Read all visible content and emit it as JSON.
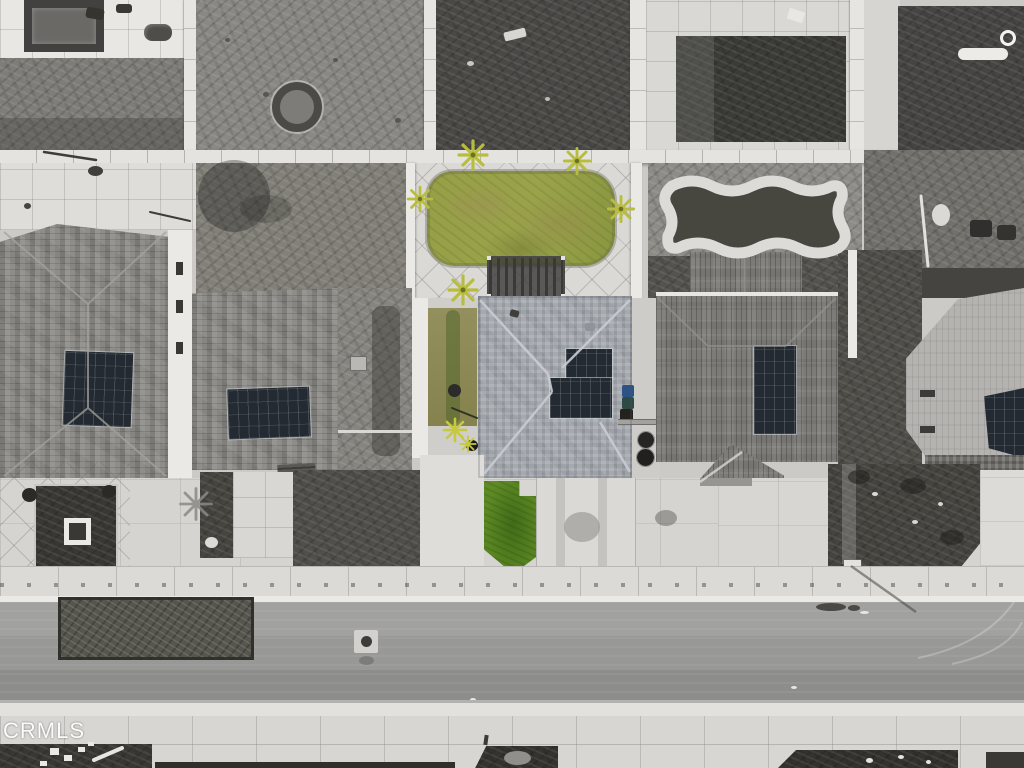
{
  "image_type": "aerial-photo",
  "watermark": {
    "text": "CRMLS"
  },
  "scene": {
    "view": "top-down drone view of a residential street block",
    "selective_color": "center property's lawns and plants rendered in green; all surroundings desaturated gray",
    "elements": [
      "rear patios and dirt yards behind concrete block walls",
      "gazebo and fire pit in rear neighbor yards",
      "row of homes with gray shingle and tile hip roofs, rooftop solar panels",
      "center home with green rear lawn ringed by concrete walk, pergola and palm trees",
      "green front lawn beside concrete driveways and trash bins",
      "public sidewalk, curb, asphalt street with manhole cover and dark pavement patch",
      "front edges of homes across the street"
    ]
  },
  "colors": {
    "concrete": "#d5d4d1",
    "concrete_bright": "#eae9e5",
    "dirt": "#8a8883",
    "dirt_dark": "#4b4a47",
    "turf_dark": "#3b3b38",
    "street_asphalt": "#989896",
    "street_patch": "#56554e",
    "roof_shingle": "#8e8d8a",
    "roof_tile_subject": "#a6aab0",
    "roof_ribbed": "#7c7b78",
    "roof_light": "#b4b3b0",
    "solar_panel": "#242a31",
    "lawn_back": "#96a046",
    "lawn_front": "#55811f",
    "side_yard_green": "#85824e",
    "palm_green": "#b9bd3e",
    "trash_bin_blue": "#2d5286",
    "watermark_white": "#ffffff"
  }
}
